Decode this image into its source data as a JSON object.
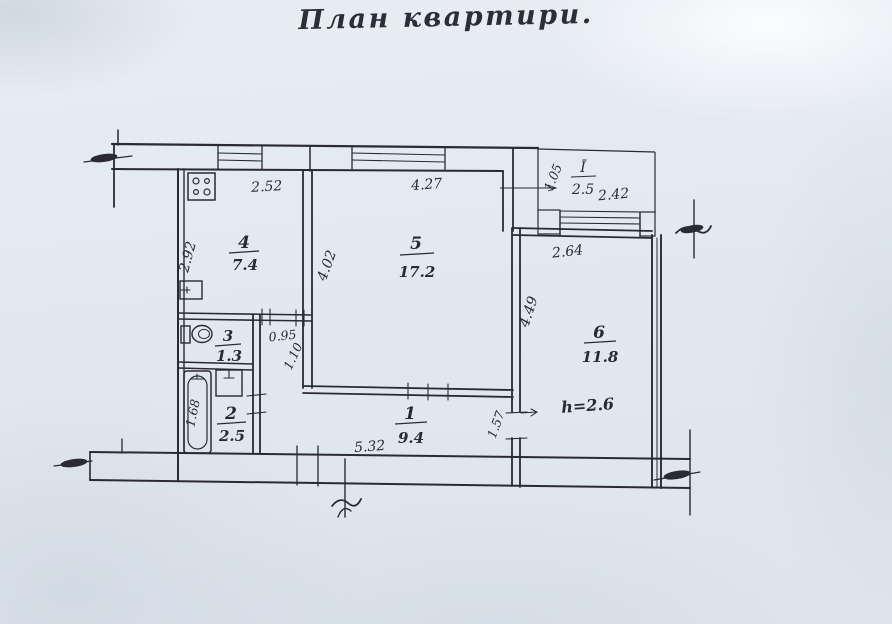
{
  "title": "План квартири.",
  "rooms": {
    "kitchen": {
      "number": "4",
      "area": "7.4"
    },
    "living": {
      "number": "5",
      "area": "17.2"
    },
    "toilet": {
      "number": "3",
      "area": "1.3"
    },
    "bath": {
      "number": "2",
      "area": "2.5"
    },
    "hall": {
      "number": "1",
      "area": "9.4"
    },
    "bedroom": {
      "number": "6",
      "area": "11.8"
    },
    "balcony": {
      "number": "Ī",
      "area": "2.5"
    }
  },
  "dimensions": {
    "kitchen_width": "2.52",
    "kitchen_depth": "2.92",
    "living_width": "4.27",
    "living_depth": "4.02",
    "nook_width": "0.95",
    "nook_depth": "1.10",
    "bathtub_length": "1.68",
    "bedroom_top": "2.64",
    "bedroom_depth": "4.49",
    "hall_right": "1.57",
    "hall_bottom": "5.32",
    "balcony_width": "2.42",
    "balcony_depth": "1.05",
    "ceiling_height": "h=2.6"
  },
  "colors": {
    "paper": "#e4eaf1",
    "ink": "#2a2a33"
  }
}
